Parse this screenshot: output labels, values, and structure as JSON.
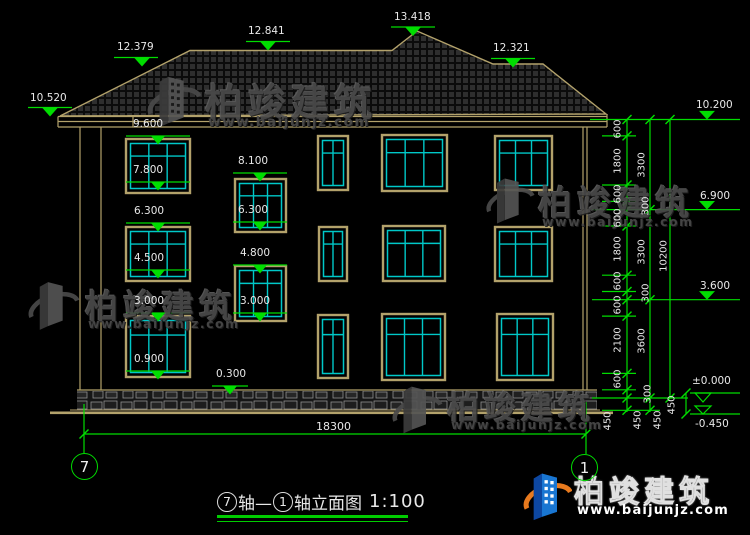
{
  "drawing": {
    "bottom_total_dim": "18300",
    "axis_left": "7",
    "axis_right": "1",
    "title": {
      "axis_from": "7",
      "mid": "轴—",
      "axis_to": "1",
      "tail": "轴立面图",
      "scale": "1:100"
    }
  },
  "watermark": {
    "name": "柏竣建筑",
    "url": "www.baijunjz.com"
  },
  "logo": {
    "name": "柏竣建筑",
    "url": "www.baijunjz.com"
  },
  "elev_markers": [
    {
      "t": "12.379",
      "x": 117,
      "y": 42
    },
    {
      "t": "12.841",
      "x": 248,
      "y": 26
    },
    {
      "t": "13.418",
      "x": 394,
      "y": 12
    },
    {
      "t": "12.321",
      "x": 493,
      "y": 43
    },
    {
      "t": "10.520",
      "x": 30,
      "y": 93
    },
    {
      "t": "10.200",
      "x": 696,
      "y": 100
    },
    {
      "t": "6.900",
      "x": 700,
      "y": 191
    },
    {
      "t": "3.600",
      "x": 700,
      "y": 281
    },
    {
      "t": "±0.000",
      "x": 692,
      "y": 376
    },
    {
      "t": "-0.450",
      "x": 695,
      "y": 419
    }
  ],
  "window_labels": [
    {
      "t": "9.600",
      "x": 133,
      "y": 119
    },
    {
      "t": "7.800",
      "x": 133,
      "y": 165
    },
    {
      "t": "6.300",
      "x": 134,
      "y": 206
    },
    {
      "t": "4.500",
      "x": 134,
      "y": 253
    },
    {
      "t": "3.000",
      "x": 134,
      "y": 296
    },
    {
      "t": "0.900",
      "x": 134,
      "y": 354
    },
    {
      "t": "8.100",
      "x": 238,
      "y": 156
    },
    {
      "t": "6.300",
      "x": 238,
      "y": 205
    },
    {
      "t": "4.800",
      "x": 240,
      "y": 248
    },
    {
      "t": "3.000",
      "x": 240,
      "y": 296
    },
    {
      "t": "0.300",
      "x": 216,
      "y": 369
    }
  ],
  "chain_labels": [
    {
      "t": "600",
      "x": 618,
      "y": 129
    },
    {
      "t": "1800",
      "x": 618,
      "y": 161
    },
    {
      "t": "600",
      "x": 618,
      "y": 194
    },
    {
      "t": "600",
      "x": 618,
      "y": 218
    },
    {
      "t": "1800",
      "x": 618,
      "y": 249
    },
    {
      "t": "600",
      "x": 618,
      "y": 281
    },
    {
      "t": "600",
      "x": 618,
      "y": 305
    },
    {
      "t": "2100",
      "x": 618,
      "y": 340
    },
    {
      "t": "600",
      "x": 618,
      "y": 379
    },
    {
      "t": "450",
      "x": 608,
      "y": 421
    },
    {
      "t": "3300",
      "x": 642,
      "y": 165
    },
    {
      "t": "300",
      "x": 646,
      "y": 206
    },
    {
      "t": "3300",
      "x": 642,
      "y": 252
    },
    {
      "t": "300",
      "x": 646,
      "y": 293
    },
    {
      "t": "3600",
      "x": 642,
      "y": 341
    },
    {
      "t": "300",
      "x": 648,
      "y": 394
    },
    {
      "t": "450",
      "x": 638,
      "y": 420
    },
    {
      "t": "10200",
      "x": 664,
      "y": 256
    },
    {
      "t": "450",
      "x": 658,
      "y": 420
    },
    {
      "t": "450",
      "x": 672,
      "y": 405
    }
  ]
}
